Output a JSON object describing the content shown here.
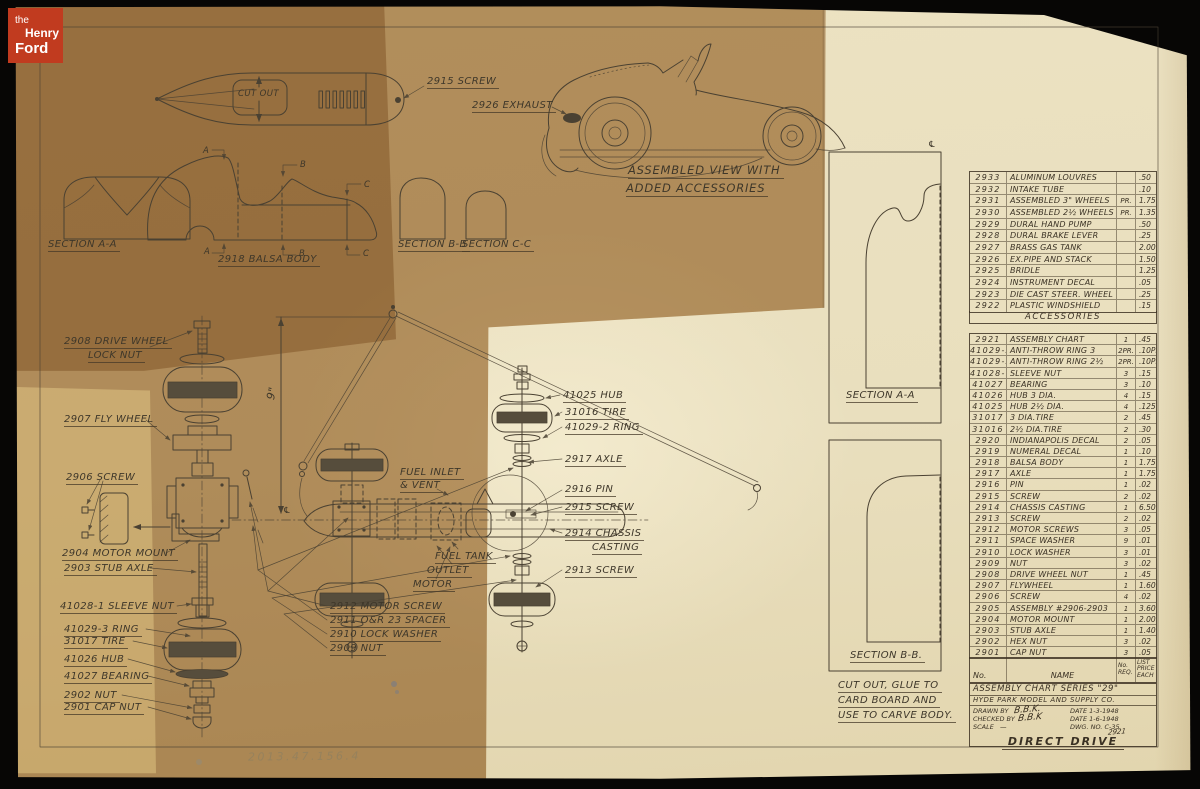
{
  "branding": {
    "the": "the",
    "henry": "Henry",
    "ford": "Ford"
  },
  "accession_number": "2013.47.156.4",
  "labels": [
    {
      "t": "2915 SCREW",
      "x": 427,
      "y": 76
    },
    {
      "t": "2926 EXHAUST",
      "x": 472,
      "y": 100
    },
    {
      "t": "ASSEMBLED VIEW WITH",
      "x": 628,
      "y": 163,
      "c": "big"
    },
    {
      "t": "ADDED ACCESSORIES",
      "x": 626,
      "y": 181,
      "c": "big"
    },
    {
      "t": "SECTION A-A",
      "x": 48,
      "y": 239
    },
    {
      "t": "2918 BALSA BODY",
      "x": 218,
      "y": 254
    },
    {
      "t": "SECTION B-B",
      "x": 398,
      "y": 239
    },
    {
      "t": "SECTION C-C",
      "x": 462,
      "y": 239
    },
    {
      "t": "CUT OUT",
      "x": 238,
      "y": 89,
      "c": "nu sm"
    },
    {
      "t": "A",
      "x": 203,
      "y": 146,
      "c": "nu sm"
    },
    {
      "t": "A",
      "x": 204,
      "y": 247,
      "c": "nu sm"
    },
    {
      "t": "B",
      "x": 300,
      "y": 160,
      "c": "nu sm"
    },
    {
      "t": "B",
      "x": 299,
      "y": 249,
      "c": "nu sm"
    },
    {
      "t": "C",
      "x": 364,
      "y": 180,
      "c": "nu sm"
    },
    {
      "t": "C",
      "x": 363,
      "y": 249,
      "c": "nu sm"
    },
    {
      "t": "2908 DRIVE WHEEL",
      "x": 64,
      "y": 336
    },
    {
      "t": "LOCK NUT",
      "x": 88,
      "y": 350
    },
    {
      "t": "2907 FLY WHEEL",
      "x": 64,
      "y": 414
    },
    {
      "t": "2906 SCREW",
      "x": 66,
      "y": 472
    },
    {
      "t": "2904 MOTOR MOUNT",
      "x": 62,
      "y": 548
    },
    {
      "t": "2903 STUB AXLE",
      "x": 64,
      "y": 563
    },
    {
      "t": "41028-1 SLEEVE NUT",
      "x": 60,
      "y": 601
    },
    {
      "t": "41029-3 RING",
      "x": 64,
      "y": 624
    },
    {
      "t": "31017 TIRE",
      "x": 64,
      "y": 636
    },
    {
      "t": "41026 HUB",
      "x": 64,
      "y": 654
    },
    {
      "t": "41027 BEARING",
      "x": 64,
      "y": 671
    },
    {
      "t": "2902 NUT",
      "x": 64,
      "y": 690
    },
    {
      "t": "2901 CAP NUT",
      "x": 64,
      "y": 702
    },
    {
      "t": "9\"",
      "x": 264,
      "y": 398,
      "c": "nu rot"
    },
    {
      "t": "℄",
      "x": 283,
      "y": 506,
      "c": "nu sm"
    },
    {
      "t": "FUEL INLET",
      "x": 400,
      "y": 467
    },
    {
      "t": "& VENT",
      "x": 400,
      "y": 480
    },
    {
      "t": "41025 HUB",
      "x": 563,
      "y": 390
    },
    {
      "t": "31016 TIRE",
      "x": 565,
      "y": 407
    },
    {
      "t": "41029-2 RING",
      "x": 565,
      "y": 422
    },
    {
      "t": "2917 AXLE",
      "x": 565,
      "y": 454
    },
    {
      "t": "2916 PIN",
      "x": 565,
      "y": 484
    },
    {
      "t": "2915 SCREW",
      "x": 565,
      "y": 502
    },
    {
      "t": "2914 CHASSIS",
      "x": 565,
      "y": 528
    },
    {
      "t": "CASTING",
      "x": 592,
      "y": 542
    },
    {
      "t": "2913 SCREW",
      "x": 565,
      "y": 565
    },
    {
      "t": "FUEL TANK",
      "x": 435,
      "y": 551
    },
    {
      "t": "OUTLET",
      "x": 427,
      "y": 565
    },
    {
      "t": "MOTOR",
      "x": 413,
      "y": 579
    },
    {
      "t": "2912  MOTOR SCREW",
      "x": 330,
      "y": 601
    },
    {
      "t": "2911  O&R 23 SPACER",
      "x": 330,
      "y": 615
    },
    {
      "t": "2910  LOCK WASHER",
      "x": 330,
      "y": 629
    },
    {
      "t": "2909  NUT",
      "x": 330,
      "y": 643
    },
    {
      "t": "SECTION A-A",
      "x": 846,
      "y": 390
    },
    {
      "t": "SECTION B-B.",
      "x": 850,
      "y": 650
    },
    {
      "t": "CUT OUT, GLUE TO",
      "x": 838,
      "y": 680
    },
    {
      "t": "CARD BOARD AND",
      "x": 838,
      "y": 695
    },
    {
      "t": "USE TO CARVE BODY.",
      "x": 838,
      "y": 710
    },
    {
      "t": "℄",
      "x": 928,
      "y": 140,
      "c": "nu sm"
    }
  ],
  "accessories_table": {
    "rows": [
      {
        "no": "2933",
        "name": "ALUMINUM LOUVRES",
        "unit": "",
        "price": ".50"
      },
      {
        "no": "2932",
        "name": "INTAKE TUBE",
        "unit": "",
        "price": ".10"
      },
      {
        "no": "2931",
        "name": "ASSEMBLED 3\" WHEELS",
        "unit": "PR.",
        "price": "1.75"
      },
      {
        "no": "2930",
        "name": "ASSEMBLED 2½ WHEELS",
        "unit": "PR.",
        "price": "1.35"
      },
      {
        "no": "2929",
        "name": "DURAL HAND PUMP",
        "unit": "",
        "price": ".50"
      },
      {
        "no": "2928",
        "name": "DURAL BRAKE LEVER",
        "unit": "",
        "price": ".25"
      },
      {
        "no": "2927",
        "name": "BRASS GAS TANK",
        "unit": "",
        "price": "2.00"
      },
      {
        "no": "2926",
        "name": "EX.PIPE AND STACK",
        "unit": "",
        "price": "1.50"
      },
      {
        "no": "2925",
        "name": "BRIDLE",
        "unit": "",
        "price": "1.25"
      },
      {
        "no": "2924",
        "name": "INSTRUMENT DECAL",
        "unit": "",
        "price": ".05"
      },
      {
        "no": "2923",
        "name": "DIE CAST STEER. WHEEL",
        "unit": "",
        "price": ".25"
      },
      {
        "no": "2922",
        "name": "PLASTIC WINDSHIELD",
        "unit": "",
        "price": ".15"
      }
    ],
    "footer": "ACCESSORIES"
  },
  "parts_table": {
    "header": {
      "no": "No.",
      "name": "NAME",
      "req": "No.\nREQ.",
      "price": "LIST\nPRICE\nEACH"
    },
    "rows": [
      {
        "no": "2921",
        "name": "ASSEMBLY CHART",
        "qty": "1",
        "price": ".45"
      },
      {
        "no": "41029-3",
        "name": "ANTI-THROW RING 3",
        "qty": "2PR.",
        "price": ".10PR."
      },
      {
        "no": "41029-2",
        "name": "ANTI-THROW RING 2½",
        "qty": "2PR.",
        "price": ".10PR."
      },
      {
        "no": "41028-1",
        "name": "SLEEVE NUT",
        "qty": "3",
        "price": ".15"
      },
      {
        "no": "41027",
        "name": "BEARING",
        "qty": "3",
        "price": ".10"
      },
      {
        "no": "41026",
        "name": "HUB 3 DIA.",
        "qty": "4",
        "price": ".15"
      },
      {
        "no": "41025",
        "name": "HUB 2½ DIA.",
        "qty": "4",
        "price": ".125"
      },
      {
        "no": "31017",
        "name": "3 DIA.TIRE",
        "qty": "2",
        "price": ".45"
      },
      {
        "no": "31016",
        "name": "2½ DIA.TIRE",
        "qty": "2",
        "price": ".30"
      },
      {
        "no": "2920",
        "name": "INDIANAPOLIS DECAL",
        "qty": "2",
        "price": ".05"
      },
      {
        "no": "2919",
        "name": "NUMERAL DECAL",
        "qty": "1",
        "price": ".10"
      },
      {
        "no": "2918",
        "name": "BALSA BODY",
        "qty": "1",
        "price": "1.75"
      },
      {
        "no": "2917",
        "name": "AXLE",
        "qty": "1",
        "price": "1.75"
      },
      {
        "no": "2916",
        "name": "PIN",
        "qty": "1",
        "price": ".02"
      },
      {
        "no": "2915",
        "name": "SCREW",
        "qty": "2",
        "price": ".02"
      },
      {
        "no": "2914",
        "name": "CHASSIS CASTING",
        "qty": "1",
        "price": "6.50"
      },
      {
        "no": "2913",
        "name": "SCREW",
        "qty": "2",
        "price": ".02"
      },
      {
        "no": "2912",
        "name": "MOTOR SCREWS",
        "qty": "3",
        "price": ".05"
      },
      {
        "no": "2911",
        "name": "SPACE WASHER",
        "qty": "9",
        "price": ".01"
      },
      {
        "no": "2910",
        "name": "LOCK WASHER",
        "qty": "3",
        "price": ".01"
      },
      {
        "no": "2909",
        "name": "NUT",
        "qty": "3",
        "price": ".02"
      },
      {
        "no": "2908",
        "name": "DRIVE WHEEL NUT",
        "qty": "1",
        "price": ".45"
      },
      {
        "no": "2907",
        "name": "FLYWHEEL",
        "qty": "1",
        "price": "1.60"
      },
      {
        "no": "2906",
        "name": "SCREW",
        "qty": "4",
        "price": ".02"
      },
      {
        "no": "2905",
        "name": "ASSEMBLY #2906-2903",
        "qty": "1",
        "price": "3.60"
      },
      {
        "no": "2904",
        "name": "MOTOR MOUNT",
        "qty": "1",
        "price": "2.00"
      },
      {
        "no": "2903",
        "name": "STUB AXLE",
        "qty": "1",
        "price": "1.40"
      },
      {
        "no": "2902",
        "name": "HEX NUT",
        "qty": "3",
        "price": ".02"
      },
      {
        "no": "2901",
        "name": "CAP NUT",
        "qty": "3",
        "price": ".05"
      }
    ]
  },
  "title_block": {
    "series": "ASSEMBLY CHART SERIES \"29\"",
    "company": "HYDE PARK MODEL AND SUPPLY CO.",
    "drawn_label": "DRAWN BY",
    "drawn_sig": "B.B.K.",
    "date1": "DATE  1-3-1948",
    "checked_label": "CHECKED BY",
    "checked_sig": "B.B.K",
    "date2": "DATE  1-6-1948",
    "scale_label": "SCALE",
    "scale_value": "—",
    "dwg": "DWG. NO. C-35",
    "dwg_sub": "2921",
    "main_title": "DIRECT DRIVE"
  }
}
